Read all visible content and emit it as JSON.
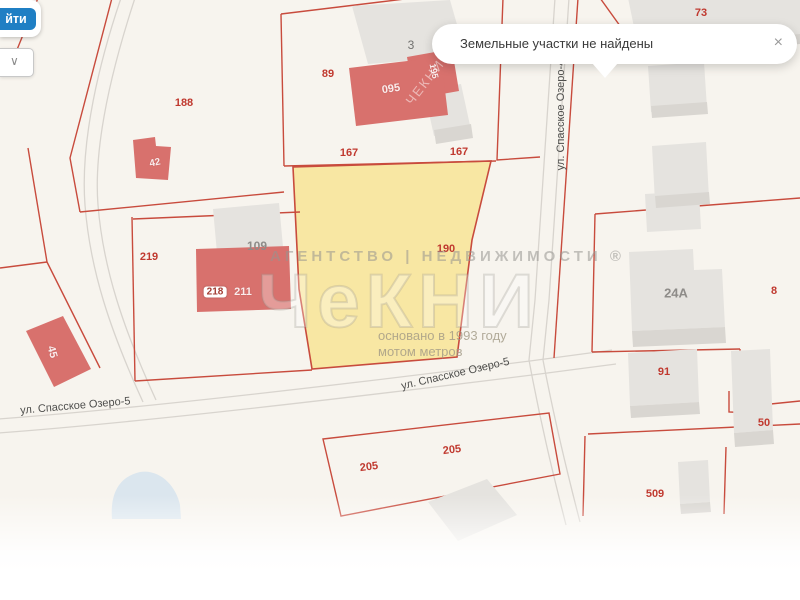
{
  "controls": {
    "find_button": "йти",
    "dropdown_chevron": "∨"
  },
  "toast": {
    "message": "Земельные участки не найдены",
    "close": "×"
  },
  "watermark": {
    "agency_line": "АГЕНТСТВО | НЕДВИЖИМОСТИ ®",
    "logo": "ЧеКНИ",
    "founded_line": "основано в 1993 году",
    "metrov_line": "мотом метров",
    "diagonal": "ЧЕКНИ"
  },
  "streets": {
    "spasskoe_ozero_5_west": "ул. Спасское Озеро-5",
    "spasskoe_ozero_5_mid": "ул. Спасское Озеро-5",
    "spasskoe_ozero_4": "ул. Спасское Озеро-4"
  },
  "labels": {
    "plot_188": "188",
    "plot_89": "89",
    "building_3": "3",
    "building_095": "095",
    "building_195": "195",
    "length_167_left": "167",
    "length_167_right": "167",
    "building_42": "42",
    "plot_219": "219",
    "building_109": "109",
    "tag_218": "218",
    "building_211": "211",
    "building_45": "45",
    "plot_190": "190",
    "plot_73": "73",
    "building_24a": "24А",
    "plot_8": "8",
    "plot_91": "91",
    "plot_50": "50",
    "plot_205_left": "205",
    "plot_205_right": "205",
    "plot_509": "509"
  },
  "colors": {
    "parcel_line": "#c84b3d",
    "highlight_parcel_fill": "#f8e7a3",
    "building_red": "#d8716d",
    "building_gray": "#e5e3df",
    "accent_blue": "#1f7fc4",
    "pond_blue": "#dbe6ee"
  }
}
